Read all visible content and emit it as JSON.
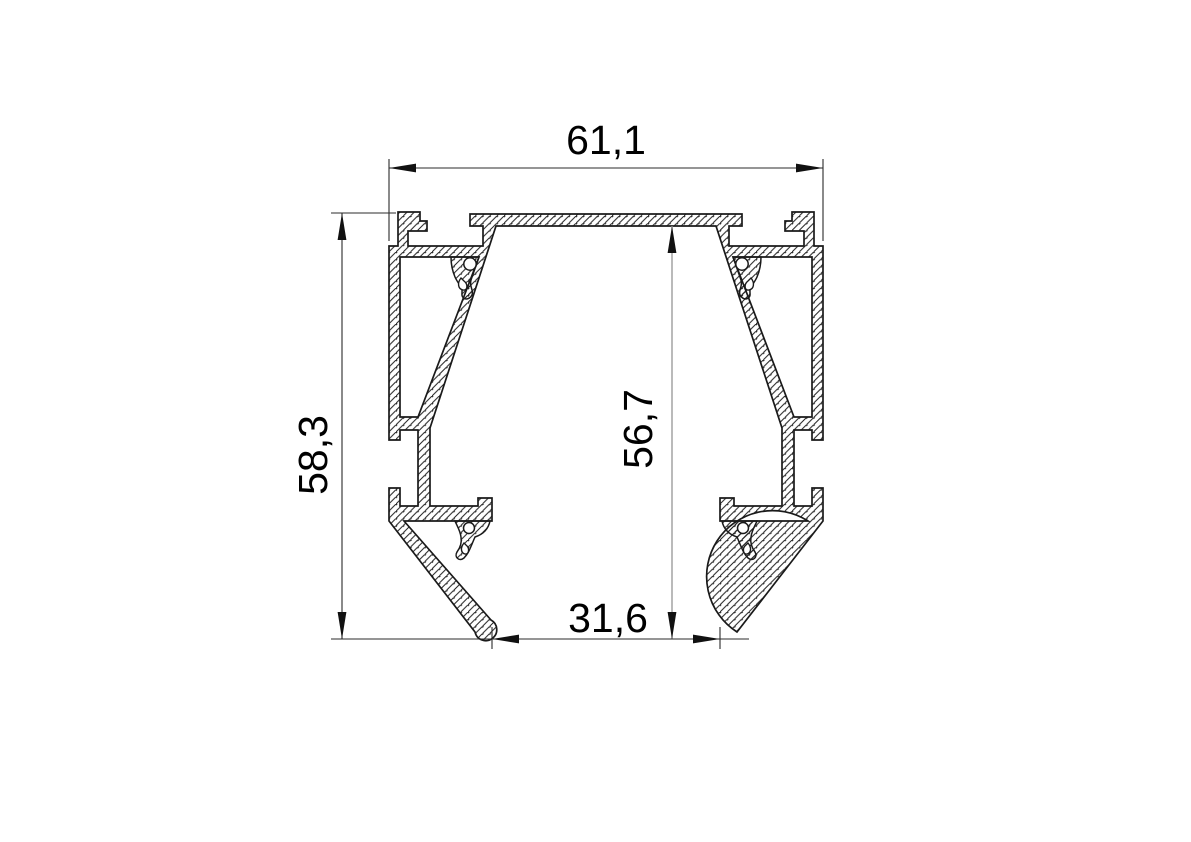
{
  "drawing": {
    "title": "aluminium-profile-cross-section",
    "background": "#ffffff",
    "colors": {
      "outline": "#1a1a1a",
      "hatch": "#1f1f1f",
      "dim_line": "#2b2b2b",
      "dim_line_light": "#9c9c9c",
      "arrow_fill": "#111111",
      "text": "#000000"
    },
    "dimensions": [
      {
        "id": "overall-width",
        "label": "61,1",
        "orientation": "horizontal"
      },
      {
        "id": "overall-height",
        "label": "58,3",
        "orientation": "vertical"
      },
      {
        "id": "inner-height",
        "label": "56,7",
        "orientation": "vertical"
      },
      {
        "id": "bottom-opening-width",
        "label": "31,6",
        "orientation": "horizontal"
      }
    ],
    "geometry": {
      "mirror_axis_x2": 1212,
      "outline": {
        "pts_before_arc": [
          [
            606,
            214
          ],
          [
            470,
            214
          ],
          [
            470,
            226
          ],
          [
            483,
            226
          ],
          [
            483,
            246
          ],
          [
            408,
            246
          ],
          [
            408,
            231
          ],
          [
            427,
            231
          ],
          [
            427,
            221
          ],
          [
            420,
            221
          ],
          [
            420,
            212
          ],
          [
            398,
            212
          ],
          [
            398,
            246
          ],
          [
            389,
            246
          ],
          [
            389,
            440
          ],
          [
            400,
            440
          ],
          [
            400,
            430
          ],
          [
            418,
            430
          ],
          [
            418,
            506
          ],
          [
            400,
            506
          ],
          [
            400,
            488
          ],
          [
            389,
            488
          ],
          [
            389,
            521
          ],
          [
            475,
            632
          ]
        ],
        "foot_r": 11,
        "arc_to": [
          491,
          620
        ],
        "pts_after_arc": [
          [
            404,
            521
          ],
          [
            492,
            521
          ],
          [
            492,
            498
          ],
          [
            478,
            498
          ],
          [
            478,
            506
          ],
          [
            430,
            506
          ],
          [
            430,
            428
          ],
          [
            496,
            226
          ],
          [
            606,
            226
          ]
        ],
        "holes": [
          "M400,257 L479,257 L418,417 L400,417 Z"
        ]
      },
      "details_hatched": [
        "M451,257 L479,257 L471,280 C469,287 474,290 472,295 C469,301 461,300 462,293 C463,287 458,284 455,277 C452,270 451,263 451,257 Z",
        "M455,521 L490,521 C488,531 481,535 475,537 C471,546 469,553 464,558 C459,562 454,557 457,552 C460,548 462,543 461,537 C460,530 457,526 455,521 Z"
      ],
      "details_white": [
        "M461,278 C457,283 458,289 463,290 C468,291 468,284 464,281 Z",
        "M464,543 C460,548 461,553 465,554 C469,555 470,548 466,545 Z"
      ],
      "knobs": [
        {
          "cx": 470,
          "cy": 264,
          "r": 6.2
        },
        {
          "cx": 469,
          "cy": 528,
          "r": 5.5
        }
      ],
      "dim_graphics": {
        "lines": [
          {
            "x1": 389,
            "y1": 168,
            "x2": 823,
            "y2": 168,
            "light": false
          },
          {
            "x1": 389,
            "y1": 159,
            "x2": 389,
            "y2": 241,
            "light": false
          },
          {
            "x1": 823,
            "y1": 159,
            "x2": 823,
            "y2": 241,
            "light": false
          },
          {
            "x1": 342,
            "y1": 213,
            "x2": 342,
            "y2": 639,
            "light": false
          },
          {
            "x1": 331,
            "y1": 213,
            "x2": 396,
            "y2": 213,
            "light": false
          },
          {
            "x1": 672,
            "y1": 226,
            "x2": 672,
            "y2": 639,
            "light": true
          },
          {
            "x1": 331,
            "y1": 639,
            "x2": 749,
            "y2": 639,
            "light": false
          },
          {
            "x1": 492,
            "y1": 627,
            "x2": 492,
            "y2": 649,
            "light": false
          },
          {
            "x1": 720,
            "y1": 627,
            "x2": 720,
            "y2": 649,
            "light": false
          }
        ],
        "arrows": [
          {
            "tip": [
              389,
              168
            ],
            "dir": "left"
          },
          {
            "tip": [
              823,
              168
            ],
            "dir": "right"
          },
          {
            "tip": [
              342,
              213
            ],
            "dir": "up"
          },
          {
            "tip": [
              342,
              639
            ],
            "dir": "down"
          },
          {
            "tip": [
              672,
              226
            ],
            "dir": "up"
          },
          {
            "tip": [
              672,
              639
            ],
            "dir": "down"
          },
          {
            "tip": [
              492,
              639
            ],
            "dir": "left"
          },
          {
            "tip": [
              720,
              639
            ],
            "dir": "right"
          }
        ],
        "arrow_len": 27,
        "arrow_halfwidth": 4.4
      }
    }
  }
}
